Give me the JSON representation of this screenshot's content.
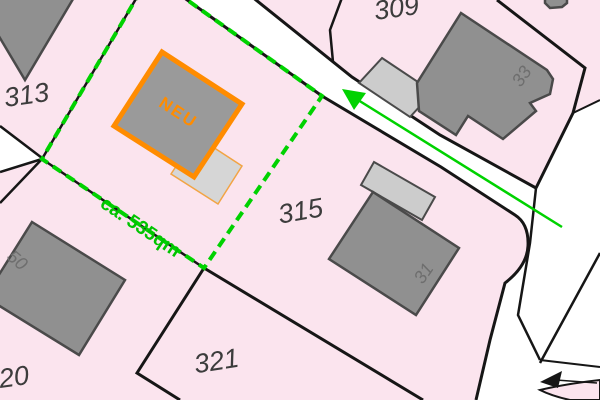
{
  "map": {
    "parcels": [
      {
        "number": "313"
      },
      {
        "number": "309"
      },
      {
        "number": "315"
      },
      {
        "number": "321"
      },
      {
        "number": "320"
      }
    ],
    "house_numbers": [
      {
        "value": "33"
      },
      {
        "value": "31"
      },
      {
        "value": "50"
      }
    ],
    "new_building": {
      "label": "NEU"
    },
    "area_annotation": {
      "label": "ca. 535qm"
    },
    "colors": {
      "parcel_pink": "#fbe4ee",
      "road_white": "#ffffff",
      "building_gray": "#909090",
      "building_outline": "#4a4a4a",
      "garage_gray": "#cccccc",
      "highlight_orange": "#ff8c00",
      "survey_green": "#00d200",
      "boundary_black": "#161616",
      "parcel_label_gray": "#3c3c3c",
      "house_number_gray": "#6e6e6e"
    }
  }
}
